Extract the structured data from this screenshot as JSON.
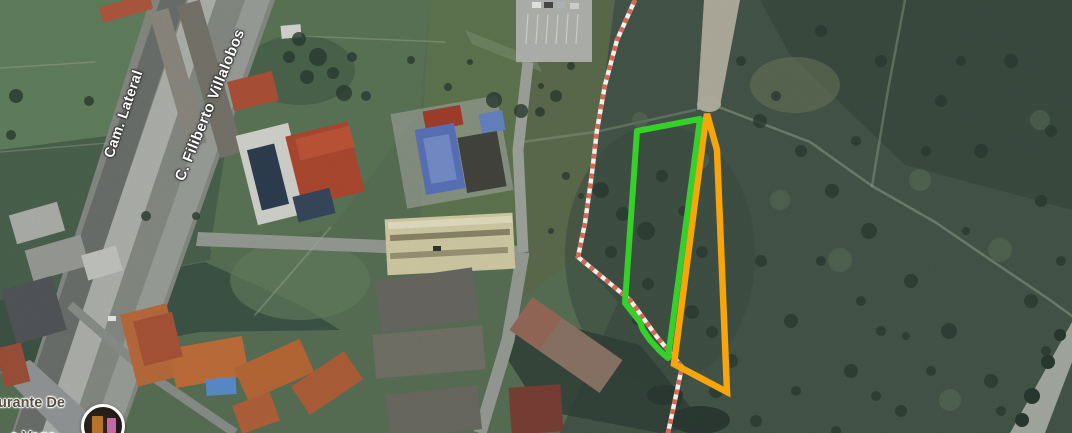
{
  "map": {
    "streets": [
      {
        "name": "Cam. Lateral"
      },
      {
        "name": "C. Filiberto Villalobos"
      }
    ],
    "poi": {
      "label_line1": "urante De",
      "label_line2": "a Vega"
    },
    "overlays": {
      "green_plot": {
        "color": "#35d02a",
        "points": "637,131 700,119 668,358 660,351 650,340 643,330 640,322 625,303"
      },
      "orange_plot": {
        "color": "#f6a50b",
        "points": "707,114 717,150 727,392 674,364 705,125"
      },
      "boundary_line": {
        "dash_color": "#d06a58",
        "base_color": "#f4eee6",
        "points": "635,0 617,40 605,85 597,130 592,173 585,223 578,257 630,300 657,337 682,367 668,433"
      }
    }
  }
}
